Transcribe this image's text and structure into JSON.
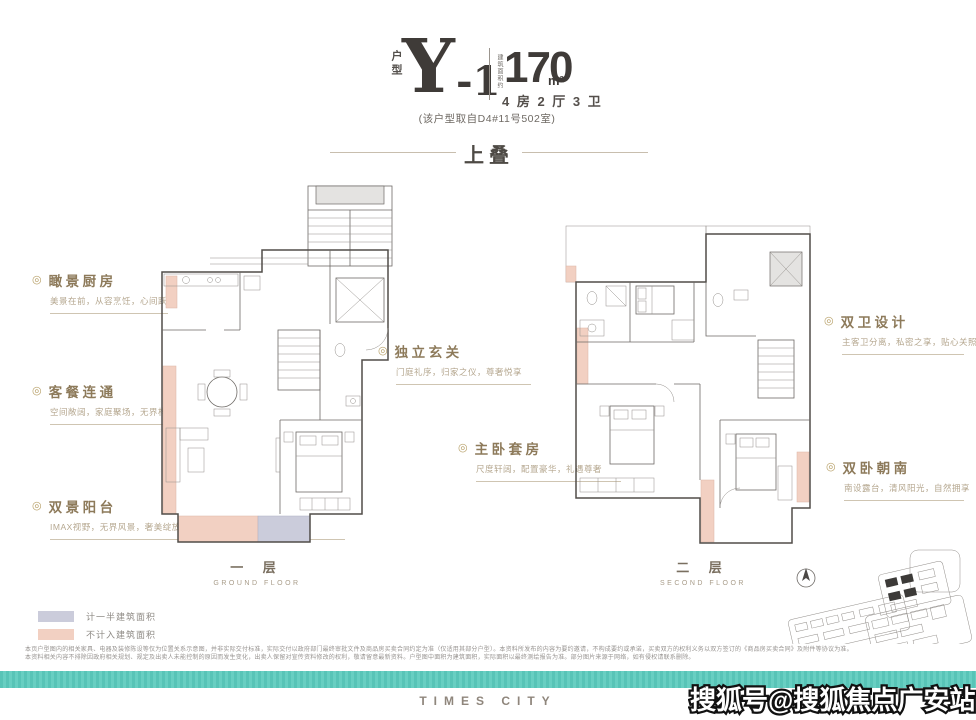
{
  "header": {
    "unit_type_label": "户型",
    "unit_name": "Y",
    "unit_suffix": "-1",
    "area_prefix": "建筑面积约",
    "area_value": "170",
    "area_unit": "m²",
    "layout": "4 房 2 厅 3 卫",
    "source_note": "(该户型取自D4#11号502室)"
  },
  "section_title": "上叠",
  "icons": {
    "marker": "◎"
  },
  "annotations": {
    "left": [
      {
        "title": "瞰景厨房",
        "desc": "美景在前，从容烹饪，心间跃然"
      },
      {
        "title": "客餐连通",
        "desc": "空间敞阔，家庭聚场，无界构建"
      },
      {
        "title": "双景阳台",
        "desc": "IMAX视野，无界风景，奢美绽放"
      }
    ],
    "middle": [
      {
        "title": "独立玄关",
        "desc": "门庭礼序，归家之仪，尊奢悦享"
      },
      {
        "title": "主卧套房",
        "desc": "尺度轩阔，配置豪华，礼遇尊奢"
      }
    ],
    "right": [
      {
        "title": "双卫设计",
        "desc": "主客卫分离，私密之享，贴心关照"
      },
      {
        "title": "双卧朝南",
        "desc": "南设露台，清风阳光，自然拥享"
      }
    ]
  },
  "floors": [
    {
      "cn": "一 层",
      "en": "GROUND FLOOR"
    },
    {
      "cn": "二 层",
      "en": "SECOND FLOOR"
    }
  ],
  "legend": [
    {
      "label": "计一半建筑面积",
      "color": "#cbccdb"
    },
    {
      "label": "不计入建筑面积",
      "color": "#f2d0c2"
    }
  ],
  "disclaimer": {
    "line1": "本页户型图内的相关家具、电器及装修陈设等仅为位置关系示意图，并非实际交付标准，实际交付以政府部门最终审批文件及商品房买卖合同约定为准（仅适用其部分户型）。本资料所发布的内容为要约邀请，不构成要约或承诺，买卖双方的权利义务以双方签订的《商品房买卖合同》及附件等协议为准。",
    "line2": "本资料相关内容不排除因政府相关规划、规定及出卖人未能控制的原因而发生变化，出卖人保留对宣传资料修改的权利，敬请留意最新资料。户型图中面积为建筑面积，实际面积以最终测绘报告为准。部分图片来源于网络，如有侵权请联系删除。"
  },
  "footer": {
    "brand": "TIMES CITY"
  },
  "watermark": "搜狐号@搜狐焦点广安站",
  "colors": {
    "accent_gold": "#8d7a5a",
    "not_counted_area": "#f2d0c2",
    "half_counted_area": "#cbccdb",
    "teal": "#5ec6b9",
    "ink": "#474443"
  }
}
